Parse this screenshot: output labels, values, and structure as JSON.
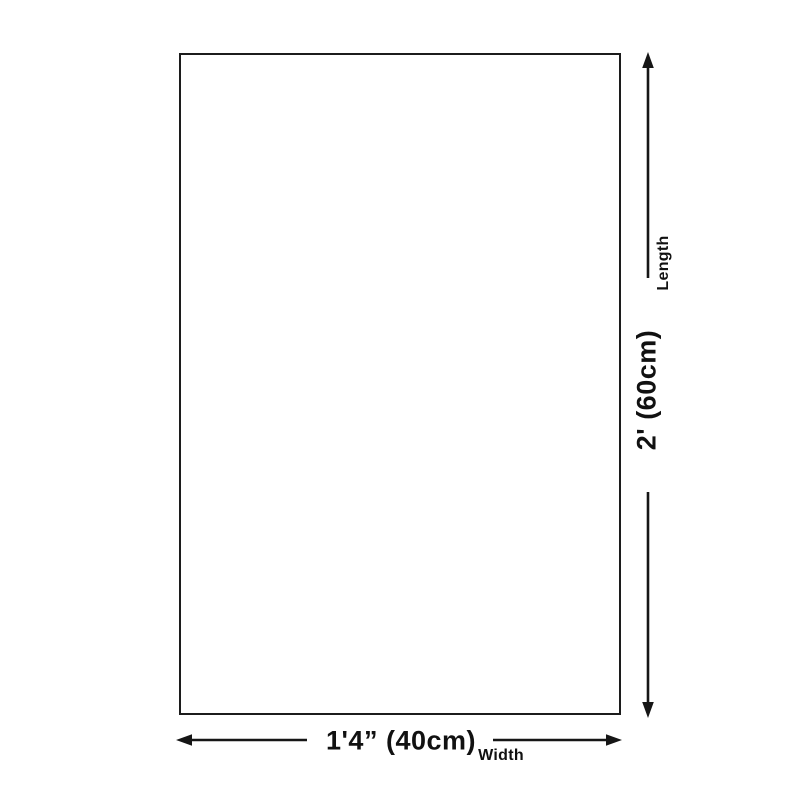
{
  "diagram": {
    "shape": "rectangle",
    "length": {
      "label": "Length",
      "value": "2' (60cm)"
    },
    "width": {
      "label": "Width",
      "value": "1'4” (40cm)"
    },
    "colors": {
      "background": "#ffffff",
      "outline": "#1c1c1c",
      "dimension_line": "#161616",
      "text": "#111111"
    }
  }
}
